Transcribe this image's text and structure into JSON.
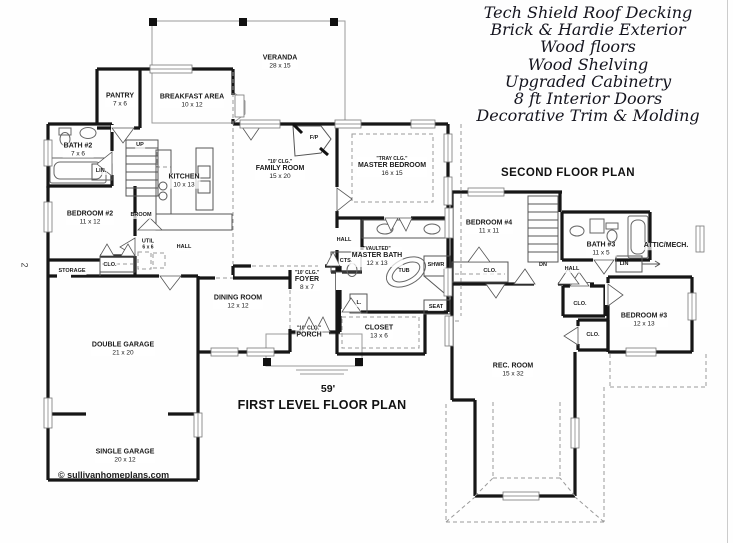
{
  "features": {
    "lines": [
      "Tech Shield Roof Decking",
      "Brick & Hardie Exterior",
      "Wood floors",
      "Wood Shelving",
      "Upgraded Cabinetry",
      "8 ft Interior Doors",
      "Decorative Trim & Molding"
    ]
  },
  "titles": {
    "second_floor": "SECOND FLOOR PLAN",
    "first_level": "FIRST LEVEL FLOOR PLAN",
    "overall_width": "59'"
  },
  "watermark": "© sullivanhomeplans.com",
  "side_mark": "2",
  "first_floor": {
    "rooms": [
      {
        "id": "veranda",
        "name": "VERANDA",
        "dims": "28 x 15"
      },
      {
        "id": "pantry",
        "name": "PANTRY",
        "dims": "7 x 6"
      },
      {
        "id": "breakfast",
        "name": "BREAKFAST AREA",
        "dims": "10 x 12"
      },
      {
        "id": "bath2",
        "name": "BATH #2",
        "dims": "7 x 6"
      },
      {
        "id": "linen",
        "name": "LIN."
      },
      {
        "id": "stairs-up",
        "name": "UP"
      },
      {
        "id": "kitchen",
        "name": "KITCHEN",
        "dims": "10 x 13"
      },
      {
        "id": "family",
        "note": "\"10' CLG.\"",
        "name": "FAMILY ROOM",
        "dims": "15 x 20"
      },
      {
        "id": "fireplace",
        "name": "F/P"
      },
      {
        "id": "master-bedroom",
        "note": "\"TRAY CLG.\"",
        "name": "MASTER BEDROOM",
        "dims": "16 x 15"
      },
      {
        "id": "bedroom2",
        "name": "BEDROOM #2",
        "dims": "11 x 12"
      },
      {
        "id": "broom",
        "name": "BROOM"
      },
      {
        "id": "util",
        "name": "UTIL",
        "dims": "6 x 6"
      },
      {
        "id": "hall",
        "name": "HALL"
      },
      {
        "id": "closet1",
        "name": "CLO."
      },
      {
        "id": "storage",
        "name": "STORAGE"
      },
      {
        "id": "double-garage",
        "name": "DOUBLE GARAGE",
        "dims": "21 x 20"
      },
      {
        "id": "single-garage",
        "name": "SINGLE GARAGE",
        "dims": "20 x 12"
      },
      {
        "id": "dining",
        "name": "DINING ROOM",
        "dims": "12 x 12"
      },
      {
        "id": "foyer",
        "note": "\"10' CLG.\"",
        "name": "FOYER",
        "dims": "8 x 7"
      },
      {
        "id": "porch",
        "note": "\"10' CLG.\"",
        "name": "PORCH"
      },
      {
        "id": "hall2",
        "name": "HALL"
      },
      {
        "id": "coats",
        "name": "CTS."
      },
      {
        "id": "master-bath",
        "note": "\"VAULTED\"",
        "name": "MASTER BATH",
        "dims": "12 x 13"
      },
      {
        "id": "tub",
        "name": "TUB"
      },
      {
        "id": "shower",
        "name": "SHWR"
      },
      {
        "id": "seat",
        "name": "SEAT"
      },
      {
        "id": "linen2",
        "name": "L."
      },
      {
        "id": "master-closet",
        "name": "CLOSET",
        "dims": "13 x 6"
      }
    ]
  },
  "second_floor": {
    "rooms": [
      {
        "id": "bedroom4",
        "name": "BEDROOM #4",
        "dims": "11 x 11"
      },
      {
        "id": "stairs-dn",
        "name": "DN"
      },
      {
        "id": "bath3",
        "name": "BATH #3",
        "dims": "11 x 5"
      },
      {
        "id": "attic",
        "name": "ATTIC/MECH."
      },
      {
        "id": "closet-a",
        "name": "CLO."
      },
      {
        "id": "hall",
        "name": "HALL"
      },
      {
        "id": "linen",
        "name": "LIN"
      },
      {
        "id": "closet-b",
        "name": "CLO."
      },
      {
        "id": "closet-c",
        "name": "CLO."
      },
      {
        "id": "bedroom3",
        "name": "BEDROOM #3",
        "dims": "12 x 13"
      },
      {
        "id": "rec-room",
        "name": "REC. ROOM",
        "dims": "15 x 32"
      }
    ]
  }
}
